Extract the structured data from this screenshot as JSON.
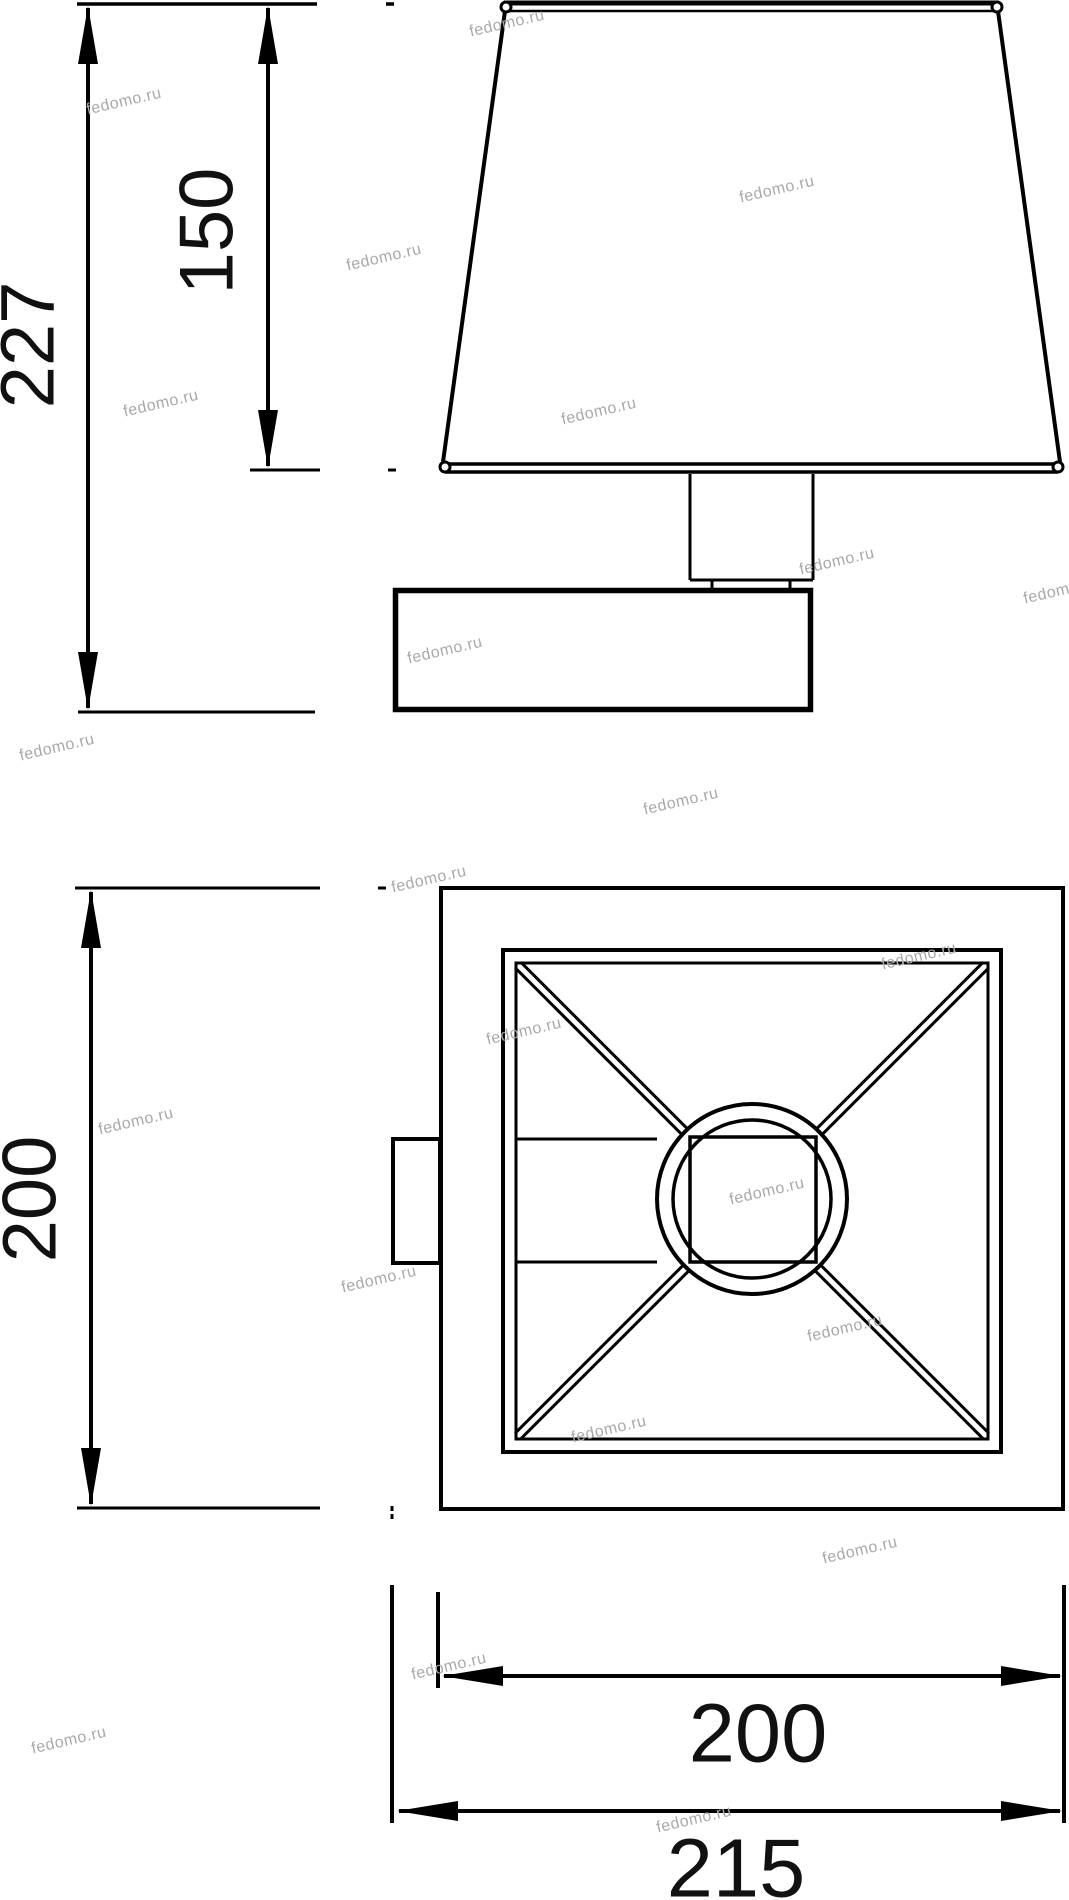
{
  "drawing": {
    "type": "technical dimensional drawing of a square wall sconce (side view and top plan view)",
    "background_color": "#ffffff",
    "line_color": "#000000",
    "text_color": "#111111",
    "dimensions": {
      "total_height": "227",
      "shade_height": "150",
      "plan_depth": "200",
      "shade_width": "200",
      "total_width": "215"
    }
  },
  "watermark": {
    "text": "fedomo.ru",
    "color": "#a9a9a9"
  }
}
